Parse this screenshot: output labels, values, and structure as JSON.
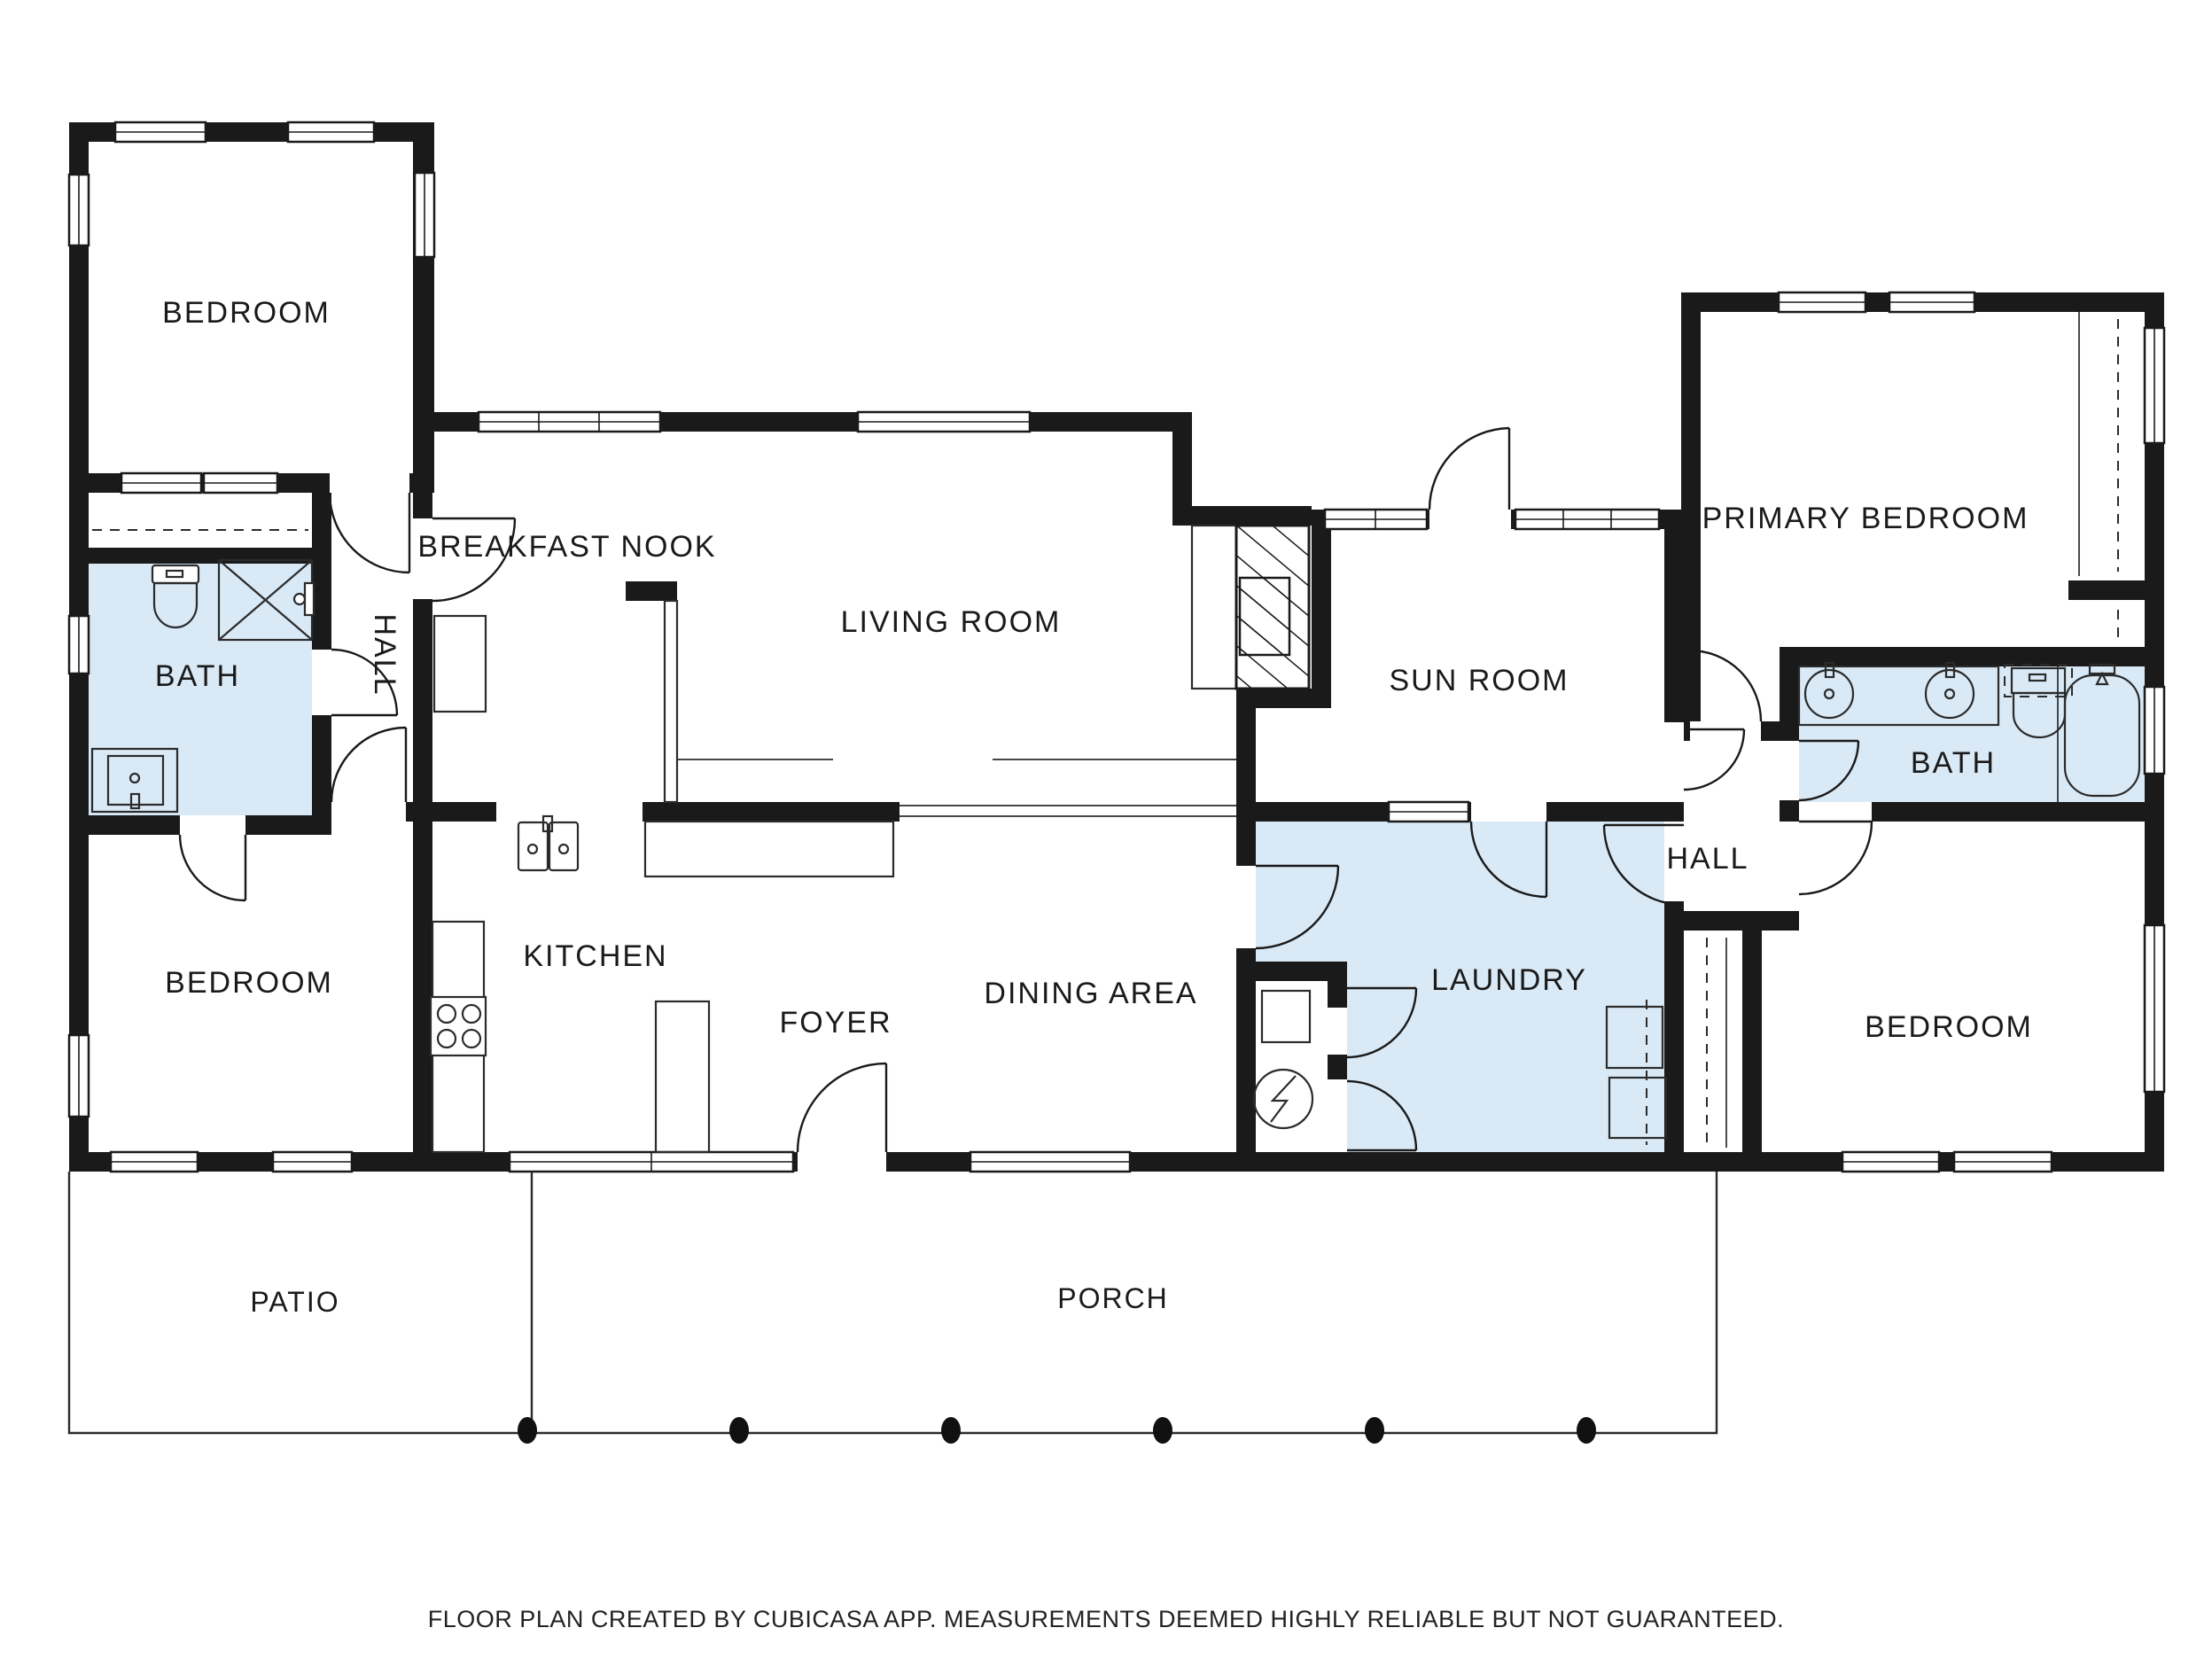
{
  "colors": {
    "wall": "#1a1a1a",
    "room_highlight": "#d9e9f6",
    "line": "#2b2b2b",
    "bg": "#ffffff"
  },
  "rooms": {
    "bedroom_nw": {
      "label": "BEDROOM"
    },
    "bath_left": {
      "label": "BATH"
    },
    "hall_left": {
      "label": "HALL"
    },
    "breakfast_nook": {
      "label": "BREAKFAST NOOK"
    },
    "living_room": {
      "label": "LIVING ROOM"
    },
    "sun_room": {
      "label": "SUN ROOM"
    },
    "primary_bedroom": {
      "label": "PRIMARY BEDROOM"
    },
    "bath_right": {
      "label": "BATH"
    },
    "hall_right": {
      "label": "HALL"
    },
    "bedroom_sw": {
      "label": "BEDROOM"
    },
    "kitchen": {
      "label": "KITCHEN"
    },
    "foyer": {
      "label": "FOYER"
    },
    "dining_area": {
      "label": "DINING AREA"
    },
    "laundry": {
      "label": "LAUNDRY"
    },
    "bedroom_se": {
      "label": "BEDROOM"
    }
  },
  "outdoor": {
    "patio": {
      "label": "PATIO"
    },
    "porch": {
      "label": "PORCH"
    }
  },
  "footer": {
    "text": "FLOOR PLAN CREATED BY CUBICASA APP. MEASUREMENTS DEEMED HIGHLY RELIABLE BUT NOT GUARANTEED."
  },
  "icons": {
    "toilet": "tank + oval bowl outline",
    "shower": "square with X and shower head",
    "bathtub": "rounded oval tub outline",
    "sink_round": "circle basin with tap",
    "sink_double": "two square basins with tap",
    "vanity_sink": "square basin in counter",
    "stove": "square with four burner circles",
    "water_heater": "circle with lightning bolt",
    "washer_dryer": "two stacked squares with dashed rail",
    "fireplace": "hatched masonry block",
    "kitchen_island": "rectangle outline",
    "porch_column": "black oval dot",
    "closet_rod": "dashed line"
  }
}
